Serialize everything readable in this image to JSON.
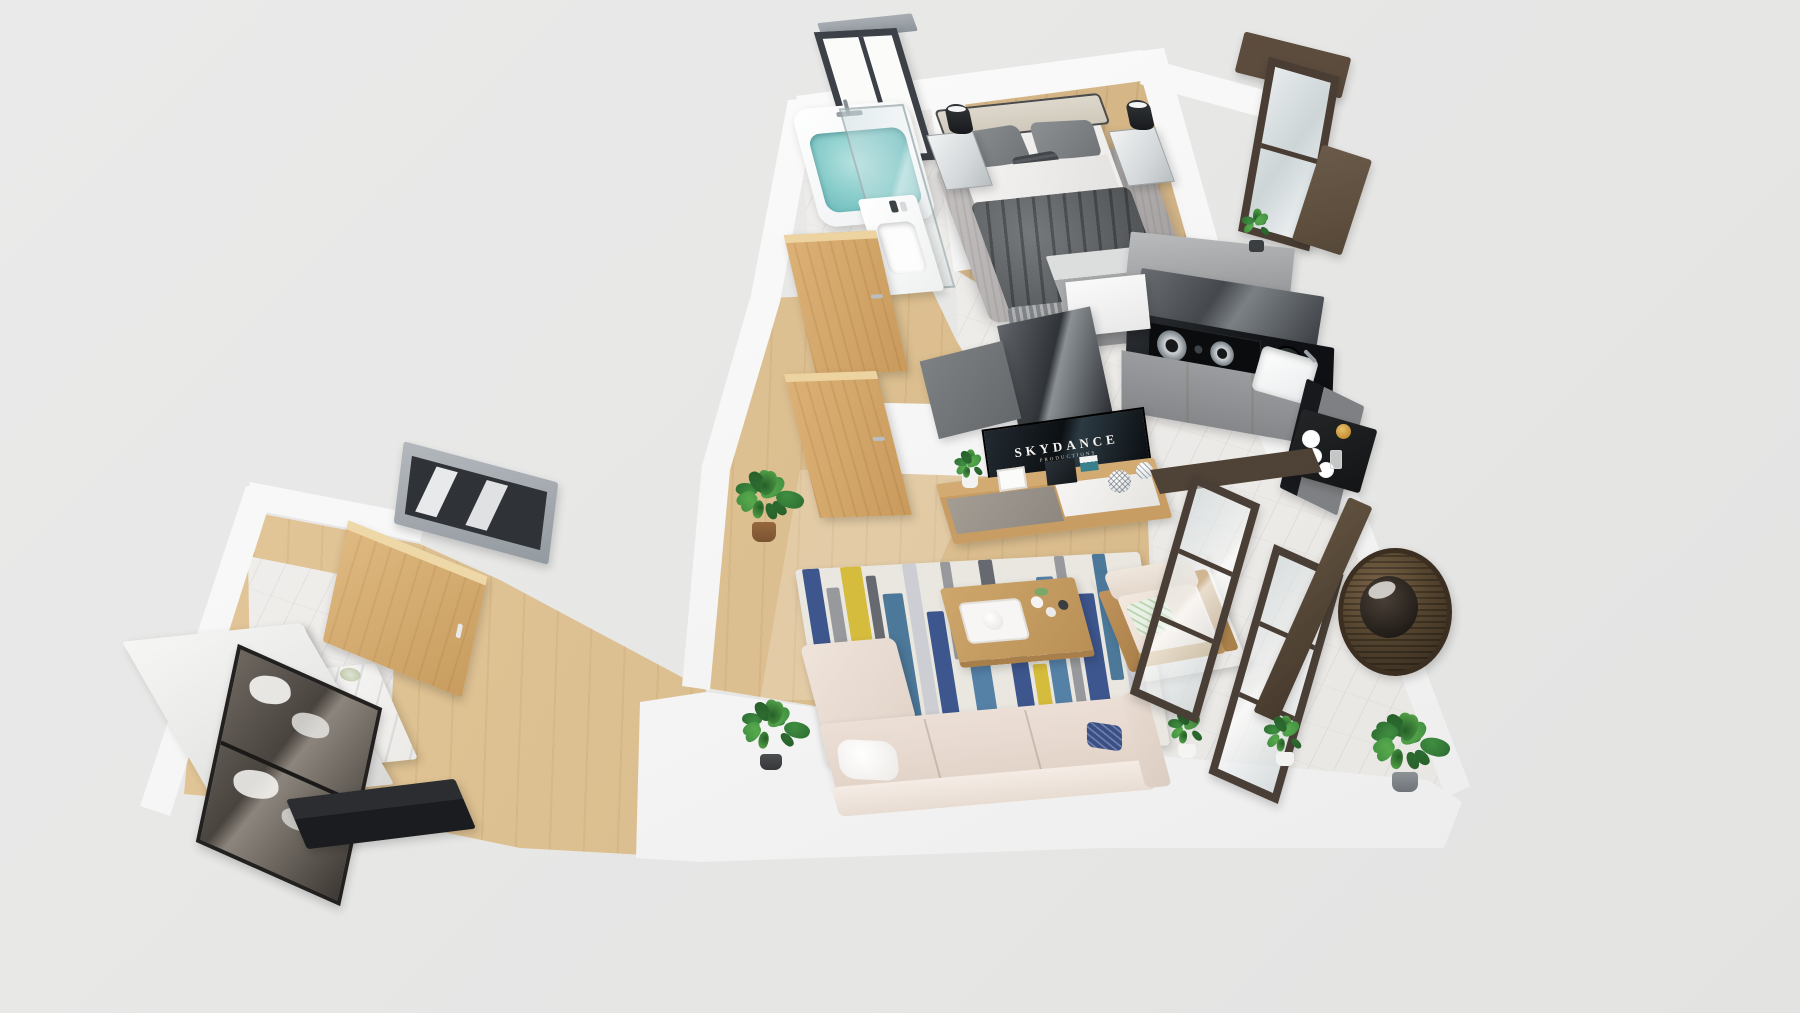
{
  "scene": {
    "title": "3D apartment floor plan render",
    "view": "isometric top-down 3D render",
    "background_color": "#e8e8e7"
  },
  "tv": {
    "line1": "SKYDANCE",
    "line2": "PRODUCTIONS"
  },
  "rooms": [
    {
      "id": "bathroom",
      "label": "Bathroom",
      "floor": "white marble",
      "items": [
        "bathtub with water",
        "shower glass panel",
        "vanity with sink",
        "framed window"
      ]
    },
    {
      "id": "bedroom",
      "label": "Bedroom",
      "floor": "light wood",
      "items": [
        "double bed",
        "beige headboard",
        "gray pillows",
        "dark gray duvet",
        "shag rug",
        "nightstand left",
        "nightstand right",
        "black cylinder lamps",
        "gray wardrobe",
        "dark framed balcony window",
        "potted plant"
      ]
    },
    {
      "id": "kitchen",
      "label": "Kitchen",
      "floor": "marble",
      "items": [
        "black L countertop",
        "two-burner gas hob",
        "black pot",
        "corner sink with faucet",
        "gray base cabinets",
        "glossy upper cabinets",
        "tall glossy panel",
        "dish shelf",
        "white plates",
        "gold cup"
      ]
    },
    {
      "id": "hallway",
      "label": "Hallway",
      "floor": "wood",
      "items": [
        "open wooden door to bathroom",
        "open wooden door to bedroom",
        "potted plant"
      ]
    },
    {
      "id": "living",
      "label": "Living room",
      "floor": "light wood",
      "items": [
        "wall TV",
        "wooden TV stand",
        "decor objects",
        "striped area rug",
        "wooden coffee table",
        "serving tray",
        "L-shaped beige sofa",
        "white blanket",
        "navy pillow",
        "armchair with wood frame",
        "potted plants"
      ]
    },
    {
      "id": "balcony",
      "label": "Balcony",
      "floor": "white marble",
      "items": [
        "dark framed sliding glass doors",
        "rattan hanging egg chair",
        "potted plants"
      ]
    },
    {
      "id": "entrance",
      "label": "Entrance / dressing area",
      "floor": "wood and marble",
      "items": [
        "leaning mirror",
        "marble vanity with sink",
        "wooden cabinet door",
        "smoked glass wardrobe with clothes",
        "black bench",
        "gray slatted window"
      ]
    }
  ],
  "palette": {
    "background": "#e8e8e7",
    "wall_white": "#f7f7f6",
    "wood_floor": "#dcbf90",
    "marble_floor": "#eceae7",
    "tub_water": "#7cc6c6",
    "duvet_gray": "#5d6063",
    "sofa_beige": "#e9ddd4",
    "counter_black": "#17191d",
    "cabinet_gray": "#8e9194",
    "door_wood": "#d5a967",
    "rattan_brown": "#5c4a36",
    "frame_dark_brown": "#4a3e34",
    "plant_green": "#3e8e3f",
    "gold_cup": "#c28f35",
    "navy_pillow": "#3a4f84"
  },
  "rug": {
    "base": "#e9e7e0",
    "stripes": [
      {
        "x": 2,
        "w": 5,
        "c": "#2e4a86",
        "t": 0,
        "h": 55
      },
      {
        "x": 8,
        "w": 4,
        "c": "#8f9296",
        "t": 10,
        "h": 90
      },
      {
        "x": 13,
        "w": 6,
        "c": "#d4b82e",
        "t": 0,
        "h": 70
      },
      {
        "x": 20,
        "w": 3,
        "c": "#5a5f66",
        "t": 5,
        "h": 60
      },
      {
        "x": 24,
        "w": 6,
        "c": "#3e6f93",
        "t": 15,
        "h": 85
      },
      {
        "x": 31,
        "w": 4,
        "c": "#c9ccd1",
        "t": 0,
        "h": 100
      },
      {
        "x": 36,
        "w": 5,
        "c": "#2e4a86",
        "t": 25,
        "h": 75
      },
      {
        "x": 42,
        "w": 3,
        "c": "#8f9296",
        "t": 0,
        "h": 50
      },
      {
        "x": 46,
        "w": 6,
        "c": "#4878a2",
        "t": 30,
        "h": 70
      },
      {
        "x": 53,
        "w": 4,
        "c": "#5a5f66",
        "t": 0,
        "h": 45
      },
      {
        "x": 58,
        "w": 5,
        "c": "#2e4a86",
        "t": 35,
        "h": 65
      },
      {
        "x": 64,
        "w": 4,
        "c": "#d4b82e",
        "t": 55,
        "h": 45
      },
      {
        "x": 69,
        "w": 5,
        "c": "#4878a2",
        "t": 10,
        "h": 90
      },
      {
        "x": 75,
        "w": 3,
        "c": "#8f9296",
        "t": 0,
        "h": 80
      },
      {
        "x": 79,
        "w": 6,
        "c": "#2e4a86",
        "t": 20,
        "h": 80
      },
      {
        "x": 86,
        "w": 4,
        "c": "#3e6f93",
        "t": 0,
        "h": 65
      },
      {
        "x": 91,
        "w": 5,
        "c": "#c9ccd1",
        "t": 30,
        "h": 70
      }
    ]
  }
}
